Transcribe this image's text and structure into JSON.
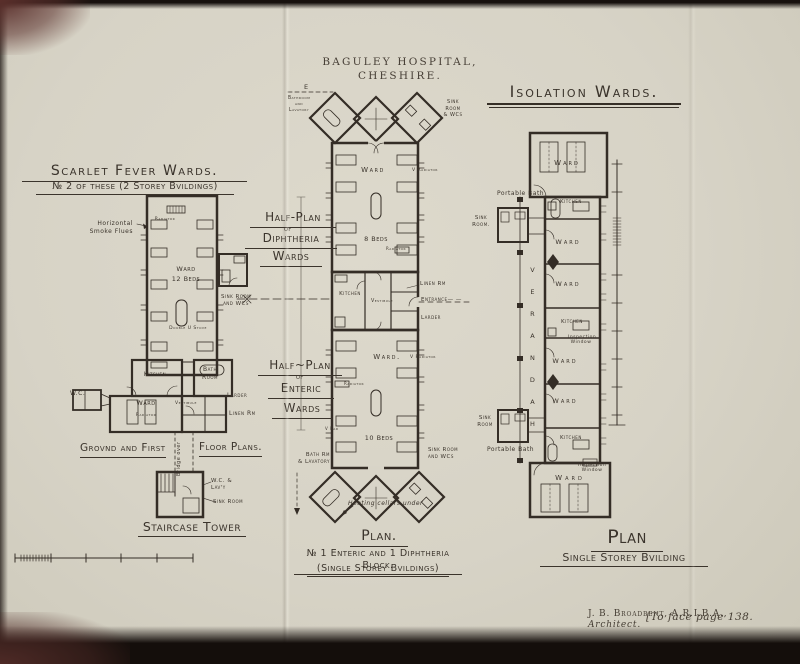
{
  "header": {
    "title": "BAGULEY HOSPITAL, CHESHIRE."
  },
  "scarlet": {
    "title1": "Scarlet Fever Wards.",
    "title2": "№ 2 of these (2 Storey Bvildings)",
    "radiator_top": "Radiator",
    "smoke_flues": "Horizontal\nSmoke Flues",
    "ward_beds": "Ward\n12 Beds",
    "sink_room": "Sink Room\nand WCs",
    "stove": "Double U Stove",
    "kitchen": "Kitchen",
    "bath_room": "Bath\nRoom",
    "wc": "W.C.",
    "ward": "Ward",
    "radiator_small": "Radiator",
    "vestibule": "Vestibule",
    "larder": "Larder",
    "linen": "Linen Rm",
    "caption_left": "Grovnd and First",
    "caption_right": "Floor Plans.",
    "bridge": "Bridge over",
    "tower_wc": "W.C. &\nLav'y",
    "tower_sink": "Sink Room",
    "tower_caption": "Staircase Tower"
  },
  "halfplan": {
    "dip": {
      "l1": "Half-Plan",
      "l2": "of",
      "l3": "Diphtheria",
      "l4": "Wards"
    },
    "ent": {
      "l1": "Half~Plan",
      "l2": "of",
      "l3": "Enteric",
      "l4": "Wards"
    },
    "e_marker": "E",
    "bathroom_lav": "Bathroom\nand\nLavatory",
    "sink_wcs_top": "Sink\nRoom\n& WCs",
    "ward_top": "Ward",
    "v_radiator_top": "V Radiator",
    "beds8": "8 Beds",
    "radiator_top_small": "Radiator",
    "kitchen": "Kitchen",
    "vestibule": "Vestibule",
    "linen": "Linen Rm",
    "entrance": "Entrance— —",
    "larder": "Larder",
    "ward_bottom": "Ward.",
    "v_radiator_bottom": "V Radiator",
    "radiator_bottom_small": "Radiator",
    "v_rad": "V Rad",
    "beds10": "10 Beds",
    "bath_lav": "Bath Rm\n& Lavatory",
    "sink_wcs_bottom": "Sink Room\nand WCs",
    "heating": "Heating cellars under",
    "caption1": "Plan.",
    "caption2": "№ 1 Enteric and 1 Diphtheria Block.",
    "caption3": "(Single Storey Bvildings)"
  },
  "isolation": {
    "title": "Isolation Wards.",
    "ward_top": "Ward",
    "portable_bath_top": "Portable Bath",
    "sink_room_top": "Sink\nRoom.",
    "kitchen1": "Kitchen",
    "ward1": "Ward",
    "ward2": "Ward",
    "kitchen2": "Kitchen",
    "ward3": "Ward",
    "ward4": "Ward",
    "kitchen3": "Kitchen",
    "verandah": "VERANDAH",
    "inspection1": "Inspection\nWindow",
    "inspection2": "Inspection\nWindow",
    "sink_room_bottom": "Sink\nRoom",
    "portable_bath_bottom": "Portable Bath",
    "ward_bottom": "Ward",
    "caption1": "Plan",
    "caption2": "Single Storey Bvilding"
  },
  "imprint": {
    "credit_name": "J. B. Broadbent, A.R.I.B.A.,",
    "credit_role": "Architect.",
    "face_page": "[To face page 138."
  }
}
